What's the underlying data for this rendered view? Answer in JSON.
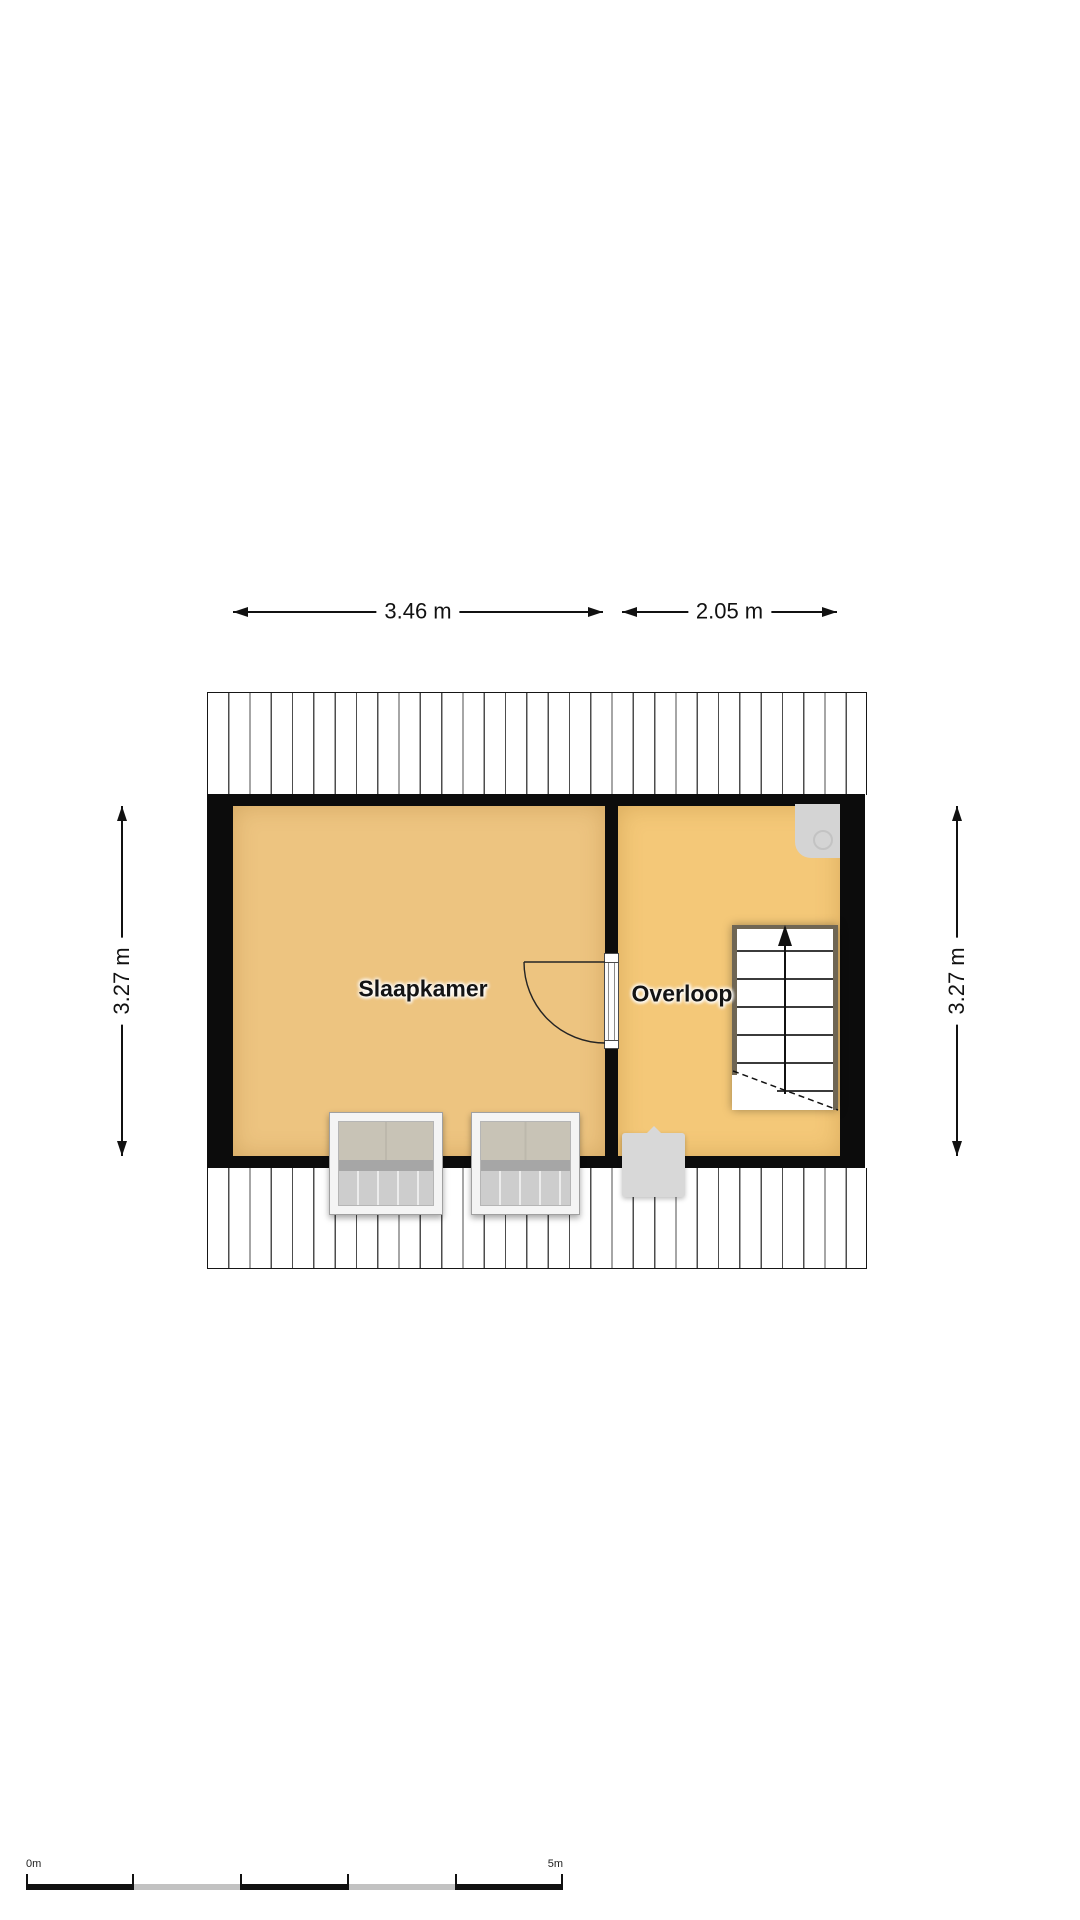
{
  "floorplan": {
    "rooms": [
      {
        "label": "Slaapkamer"
      },
      {
        "label": "Overloop"
      }
    ],
    "dimensions": {
      "top_left": "3.46 m",
      "top_right": "2.05 m",
      "left": "3.27 m",
      "right": "3.27 m"
    },
    "scale_bar": {
      "start": "0m",
      "end": "5m"
    },
    "stairs": {
      "icon": "stairs-up-arrow"
    },
    "colors": {
      "wall": "#0c0c0c",
      "slaapkamer_fill": "#edc480",
      "overloop_fill": "#f4c878",
      "fixture_gray": "#d6d6d6",
      "window_pane_top": "#c8c3b6",
      "window_pane_bottom": "#cdcdcd",
      "stair_stringer": "#6f6654"
    }
  }
}
